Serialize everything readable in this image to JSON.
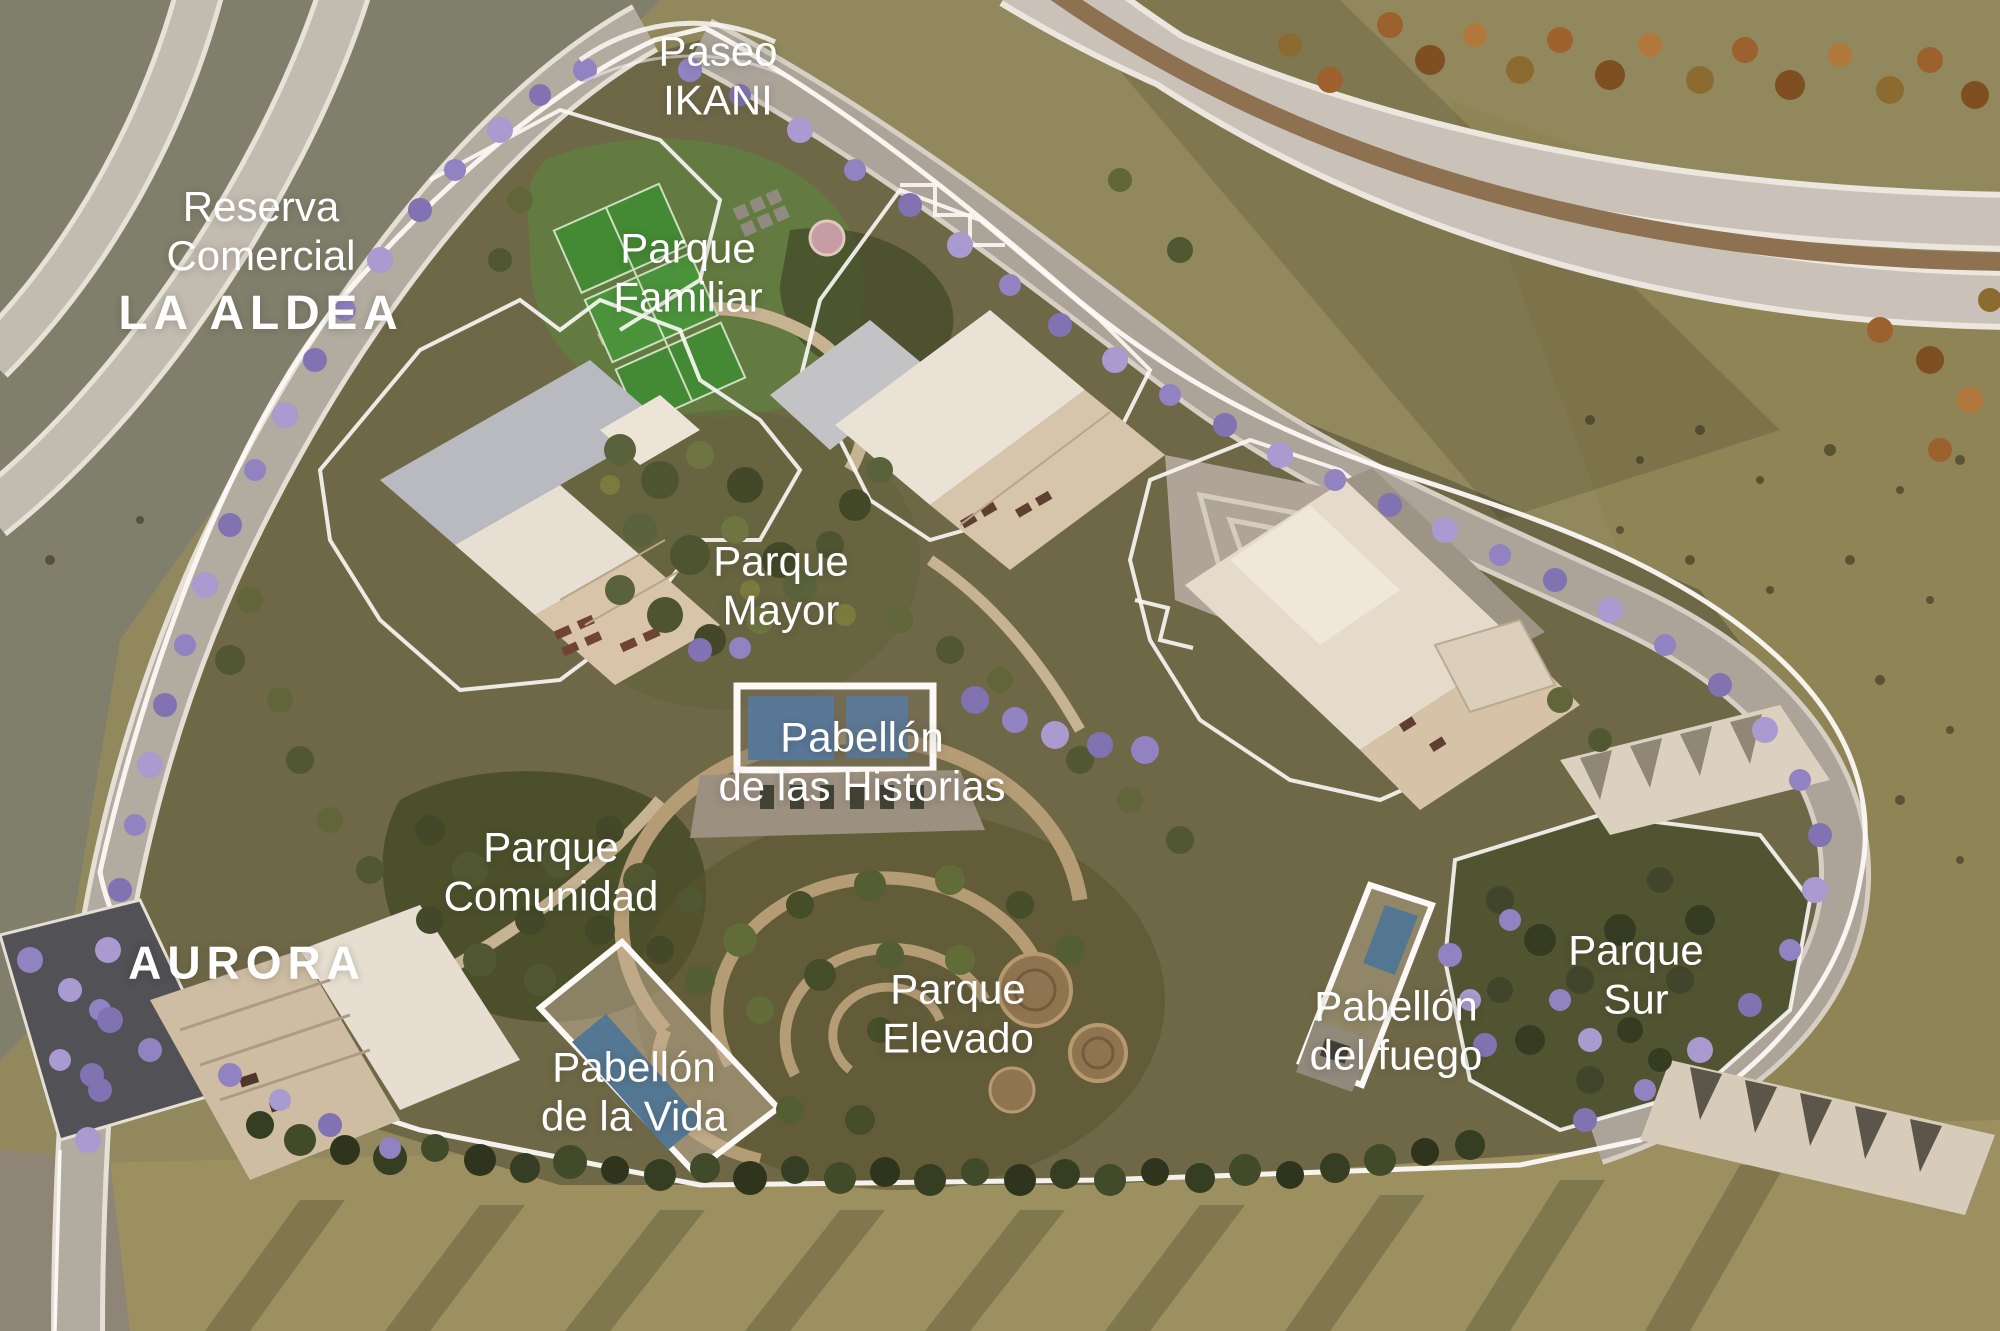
{
  "map": {
    "type": "masterplan-aerial-render",
    "labels": {
      "paseo": "Paseo\nIKANI",
      "reserva": {
        "lines": "Reserva\nComercial",
        "name": "LA ALDEA"
      },
      "parque_familiar": "Parque\nFamiliar",
      "parque_mayor": "Parque\nMayor",
      "pabellon_historias": "Pabellón\nde las Historias",
      "parque_comunidad": "Parque\nComunidad",
      "aurora": "AURORA",
      "pabellon_vida": "Pabellón\nde la Vida",
      "parque_elevado": "Parque\nElevado",
      "pabellon_fuego": "Pabellón\ndel fuego",
      "parque_sur": "Parque\nSur"
    },
    "colors": {
      "label_text": "#ffffff",
      "boundary_line": "#ffffff",
      "road": "#b2ada4",
      "highway": "#cbc6be",
      "highway_median": "#8b7052",
      "jacaranda": "#8f82c8",
      "pool_water": "#54769b",
      "terrain_scrub": "#8f8a5e",
      "terrain_site": "#6b6747",
      "building_cream": "#d8c8ae",
      "building_roof_white": "#ece6da",
      "building_roof_grey": "#b9bdc6",
      "park_green_dark": "#454d2a",
      "court_green": "#3e8a32",
      "playground_pink": "#c79fa9"
    }
  }
}
